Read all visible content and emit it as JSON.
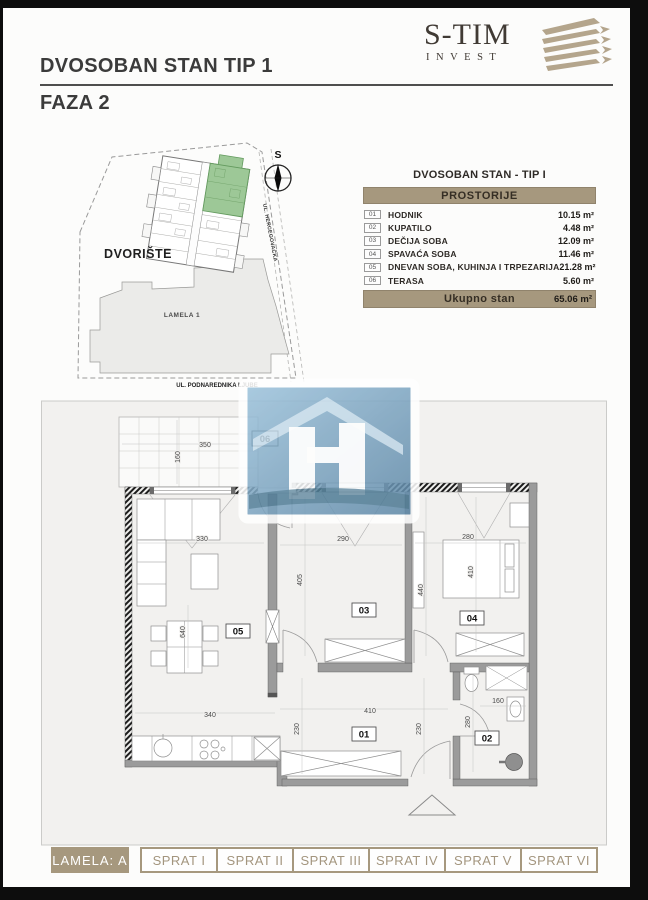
{
  "header": {
    "title": "DVOSOBAN STAN TIP 1",
    "phase": "FAZA 2",
    "logo_name": "S-TIM",
    "logo_sub": "INVEST"
  },
  "site_plan": {
    "north_label": "S",
    "courtyard": "DVORIŠTE",
    "building": "LAMELA 1",
    "street_side": "UL. HERCEGOVAČKA",
    "street_bottom": "UL. PODNAREDNIKA LJUBE"
  },
  "rooms_table": {
    "title": "DVOSOBAN STAN - TIP I",
    "header": "PROSTORIJE",
    "rows": [
      {
        "num": "01",
        "name": "HODNIK",
        "area": "10.15 m²"
      },
      {
        "num": "02",
        "name": "KUPATILO",
        "area": "4.48 m²"
      },
      {
        "num": "03",
        "name": "DEČIJA SOBA",
        "area": "12.09 m²"
      },
      {
        "num": "04",
        "name": "SPAVAĆA SOBA",
        "area": "11.46 m²"
      },
      {
        "num": "05",
        "name": "DNEVAN SOBA, KUHINJA I TRPEZARIJA",
        "area": "21.28 m²"
      },
      {
        "num": "06",
        "name": "TERASA",
        "area": "5.60 m²"
      }
    ],
    "total_label": "Ukupno stan",
    "total_area": "65.06 m²"
  },
  "floor_plan": {
    "labels": {
      "r1": "01",
      "r2": "02",
      "r3": "03",
      "r4": "04",
      "r5": "05",
      "r6": "06"
    },
    "dims": {
      "terrace_w": "350",
      "terrace_d": "160",
      "sofa_w": "330",
      "table_h": "640",
      "kitchen_w": "340",
      "r3_w": "290",
      "r3_d": "405",
      "r3_d2": "440",
      "r4_w": "280",
      "r4_d": "410",
      "hall_w": "410",
      "hall_d1": "230",
      "hall_d2": "230",
      "bath_w": "160",
      "bath_d": "280"
    }
  },
  "footer": {
    "lamela_label": "LAMELA: A",
    "floors": [
      "SPRAT I",
      "SPRAT II",
      "SPRAT III",
      "SPRAT IV",
      "SPRAT V",
      "SPRAT VI"
    ]
  },
  "colors": {
    "accent_tan": "#a6987e",
    "highlight_green": "#9dc897",
    "watermark_blue": "#6f9cbd",
    "wall_gray": "#9b9b9b"
  }
}
